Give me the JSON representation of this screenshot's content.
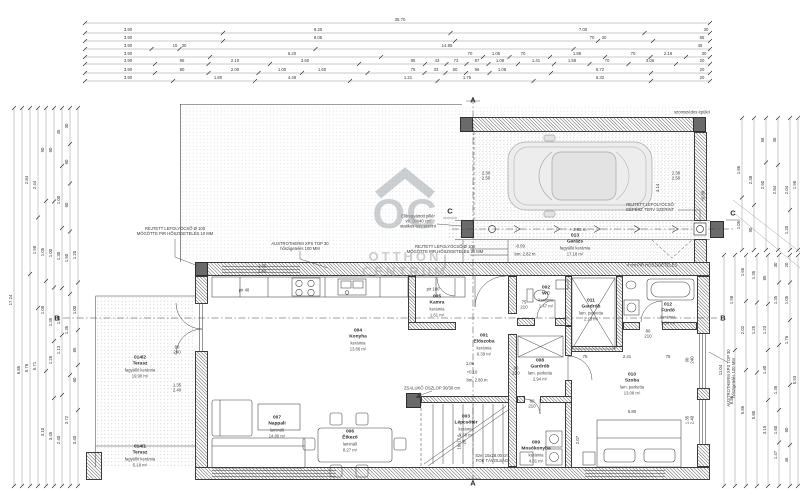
{
  "watermark": {
    "logo": "OC",
    "line1": "OTTHON",
    "line2": "CENTRUM"
  },
  "rooms": [
    {
      "num": "001",
      "name": "Előszoba",
      "finish": "kerámia",
      "area": "6.39 m²",
      "x": 484,
      "y": 345
    },
    {
      "num": "002",
      "name": "WC",
      "finish": "kerámia",
      "area": "1.47 m²",
      "x": 546,
      "y": 297
    },
    {
      "num": "003",
      "name": "Lépcsőtér",
      "finish": "kerámia",
      "area": "3.68 m²",
      "x": 466,
      "y": 426
    },
    {
      "num": "004",
      "name": "Konyha",
      "finish": "kerámia",
      "area": "13.86 m²",
      "x": 358,
      "y": 340
    },
    {
      "num": "005",
      "name": "Kamra",
      "finish": "kerámia",
      "area": "1.61 m²",
      "x": 437,
      "y": 306
    },
    {
      "num": "006",
      "name": "Étkező",
      "finish": "laminált",
      "area": "8.27 m²",
      "x": 350,
      "y": 441
    },
    {
      "num": "007",
      "name": "Nappali",
      "finish": "laminált",
      "area": "14.80 m²",
      "x": 277,
      "y": 427
    },
    {
      "num": "008",
      "name": "Gardrób",
      "finish": "lam. parketta",
      "area": "2.94 m²",
      "x": 540,
      "y": 370
    },
    {
      "num": "009",
      "name": "Mosókonyha",
      "finish": "kerámia",
      "area": "4.81 m²",
      "x": 536,
      "y": 452
    },
    {
      "num": "010",
      "name": "Szoba",
      "finish": "lam. parketta",
      "area": "13.08 m²",
      "x": 632,
      "y": 384
    },
    {
      "num": "011",
      "name": "Gardrób",
      "finish": "lam. parketta",
      "area": "2.13 m²",
      "x": 591,
      "y": 310
    },
    {
      "num": "012",
      "name": "Fürdő",
      "finish": "kerámia",
      "area": "5.34 m²",
      "x": 668,
      "y": 314
    },
    {
      "num": "013",
      "name": "Garázs",
      "finish": "fagyálló kerámia",
      "area": "17.18 m²",
      "x": 575,
      "y": 245
    },
    {
      "num": "014/1",
      "name": "Terasz",
      "finish": "fagyálló kerámia",
      "area": "5.18 m²",
      "x": 140,
      "y": 456
    },
    {
      "num": "014/2",
      "name": "Terasz",
      "finish": "fagyálló kerámia",
      "area": "19.90 m²",
      "x": 140,
      "y": 367
    }
  ],
  "annotations": [
    {
      "t": "REJTETT LEFOLYÓCSŐ Ø 100\nMÖGÖTTE PIR HŐSZIGETELÉS 10 MM",
      "x": 175,
      "y": 231
    },
    {
      "t": "AUSTROTHERM XPS TOP 30\nhőszigetelés 100 MM",
      "x": 300,
      "y": 246
    },
    {
      "t": "REJTETT LEFOLYÓCSŐ Ø 100\nMÖGÖTTE PIR HŐSZIGETELÉS 20 MM",
      "x": 445,
      "y": 249
    },
    {
      "t": "REJTETT LEFOLYÓCSŐ\nGÉPÉSZ TERV SZERINT",
      "x": 650,
      "y": 207
    },
    {
      "t": "Előregyártott pillér\nvb. 30x40 cm\nstatikus terv szerint",
      "x": 418,
      "y": 221
    },
    {
      "t": "4 cm PIR HŐSZIGETELÉS",
      "x": 652,
      "y": 264.5
    },
    {
      "t": "ZSALUKŐ OSZLOP 30/30 cm",
      "x": 432,
      "y": 388
    },
    {
      "t": "AUSTROTHERM XPS TOP 30\nhőszigetelés 100 MM",
      "x": 731,
      "y": 378,
      "rot": 1
    },
    {
      "t": "Sze: 15x28.00 cm\nFOK TÁVOLSÁG",
      "x": 492,
      "y": 458
    },
    {
      "t": "szomszédos épület",
      "x": 692,
      "y": 112
    },
    {
      "t": "pir 40",
      "x": 244,
      "y": 290
    },
    {
      "t": "pir 100",
      "x": 433,
      "y": 289
    },
    {
      "t": "+0.10",
      "x": 472,
      "y": 372
    },
    {
      "t": "bm: 2.80 m",
      "x": 477,
      "y": 380
    },
    {
      "t": "-0.09",
      "x": 520,
      "y": 246
    },
    {
      "t": "bm: 2.82 m",
      "x": 525,
      "y": 254
    },
    {
      "t": "+0.08",
      "x": 703,
      "y": 196,
      "rot": 1
    }
  ],
  "sections": [
    {
      "t": "A",
      "x": 473,
      "y": 100
    },
    {
      "t": "A",
      "x": 473,
      "y": 483
    },
    {
      "t": "B",
      "x": 57,
      "y": 318
    },
    {
      "t": "B",
      "x": 723,
      "y": 318
    },
    {
      "t": "C",
      "x": 450,
      "y": 211
    },
    {
      "t": "C",
      "x": 733,
      "y": 213
    }
  ],
  "dims": {
    "top_rows": [
      {
        "y": 23,
        "labels": [
          {
            "t": "35.70",
            "x": 400
          }
        ]
      },
      {
        "y": 33,
        "labels": [
          {
            "t": "3.90",
            "x": 128
          },
          {
            "t": "8.20",
            "x": 318
          },
          {
            "t": "7.00",
            "x": 583
          },
          {
            "t": "30",
            "x": 706
          }
        ]
      },
      {
        "y": 41,
        "labels": [
          {
            "t": "3.90",
            "x": 128
          },
          {
            "t": "8.05",
            "x": 318
          },
          {
            "t": "70",
            "x": 592
          },
          {
            "t": "30",
            "x": 604
          },
          {
            "t": "65",
            "x": 702
          }
        ]
      },
      {
        "y": 49,
        "labels": [
          {
            "t": "3.90",
            "x": 128
          },
          {
            "t": "15",
            "x": 175
          },
          {
            "t": "30",
            "x": 184
          },
          {
            "t": "14.85",
            "x": 447
          },
          {
            "t": "45",
            "x": 700
          }
        ]
      },
      {
        "y": 57,
        "labels": [
          {
            "t": "3.90",
            "x": 128
          },
          {
            "t": "6.20",
            "x": 292
          },
          {
            "t": "70",
            "x": 470
          },
          {
            "t": "1.05",
            "x": 496
          },
          {
            "t": "70",
            "x": 523
          },
          {
            "t": "1.88",
            "x": 577
          },
          {
            "t": "70",
            "x": 633
          },
          {
            "t": "2.18",
            "x": 668
          },
          {
            "t": "30",
            "x": 704
          }
        ]
      },
      {
        "y": 64,
        "labels": [
          {
            "t": "3.90",
            "x": 128
          },
          {
            "t": "95",
            "x": 182
          },
          {
            "t": "2.10",
            "x": 235
          },
          {
            "t": "3.60",
            "x": 305
          },
          {
            "t": "85",
            "x": 413
          },
          {
            "t": "43",
            "x": 437
          },
          {
            "t": "73",
            "x": 456
          },
          {
            "t": "87",
            "x": 477
          },
          {
            "t": "1.08",
            "x": 500
          },
          {
            "t": "1.41",
            "x": 536
          },
          {
            "t": "1.58",
            "x": 572
          },
          {
            "t": "70",
            "x": 607
          },
          {
            "t": "3.06",
            "x": 650
          },
          {
            "t": "20",
            "x": 702
          }
        ]
      },
      {
        "y": 73,
        "labels": [
          {
            "t": "3.90",
            "x": 128
          },
          {
            "t": "90",
            "x": 182
          },
          {
            "t": "2.00",
            "x": 235
          },
          {
            "t": "1.00",
            "x": 282
          },
          {
            "t": "1.60",
            "x": 322
          },
          {
            "t": "75",
            "x": 413
          },
          {
            "t": "33",
            "x": 436
          },
          {
            "t": "60",
            "x": 455
          },
          {
            "t": "96",
            "x": 477
          },
          {
            "t": "1.08",
            "x": 502
          },
          {
            "t": "5.72",
            "x": 600
          },
          {
            "t": "20",
            "x": 702
          }
        ]
      },
      {
        "y": 81,
        "labels": [
          {
            "t": "3.90",
            "x": 128
          },
          {
            "t": "1.80",
            "x": 218
          },
          {
            "t": "4.48",
            "x": 292
          },
          {
            "t": "1.21",
            "x": 408
          },
          {
            "t": "1.75",
            "x": 467
          },
          {
            "t": "6.32",
            "x": 600
          },
          {
            "t": "20",
            "x": 702
          }
        ]
      }
    ],
    "left_cols": [
      {
        "x": 14,
        "labels": [
          {
            "t": "17.24",
            "y": 300
          }
        ]
      },
      {
        "x": 22,
        "labels": [
          {
            "t": "6.85",
            "y": 370
          }
        ]
      },
      {
        "x": 30,
        "labels": [
          {
            "t": "2.84",
            "y": 180
          },
          {
            "t": "5.76",
            "y": 368
          }
        ]
      },
      {
        "x": 38,
        "labels": [
          {
            "t": "2.44",
            "y": 185
          },
          {
            "t": "1.98",
            "y": 250
          },
          {
            "t": "5.71",
            "y": 366
          }
        ]
      },
      {
        "x": 46,
        "labels": [
          {
            "t": "90",
            "y": 150
          },
          {
            "t": "1.05",
            "y": 252
          },
          {
            "t": "1.08",
            "y": 310
          },
          {
            "t": "3.10",
            "y": 432
          }
        ]
      },
      {
        "x": 54,
        "labels": [
          {
            "t": "60",
            "y": 150
          },
          {
            "t": "1.00",
            "y": 253
          },
          {
            "t": "1.35",
            "y": 322
          },
          {
            "t": "1.26",
            "y": 360
          },
          {
            "t": "3.45",
            "y": 436
          }
        ]
      },
      {
        "x": 62,
        "labels": [
          {
            "t": "45",
            "y": 132
          },
          {
            "t": "1.00",
            "y": 200
          },
          {
            "t": "1.30",
            "y": 256
          },
          {
            "t": "1.08",
            "y": 320
          },
          {
            "t": "1.13",
            "y": 350
          },
          {
            "t": "2.40",
            "y": 440
          }
        ]
      },
      {
        "x": 70,
        "labels": [
          {
            "t": "30",
            "y": 126
          },
          {
            "t": "90",
            "y": 162
          },
          {
            "t": "60",
            "y": 205
          },
          {
            "t": "1.50",
            "y": 258
          },
          {
            "t": "1.35",
            "y": 330
          },
          {
            "t": "3.72",
            "y": 420
          }
        ]
      },
      {
        "x": 78,
        "labels": [
          {
            "t": "1.20",
            "y": 255
          },
          {
            "t": "1.00",
            "y": 310
          },
          {
            "t": "85",
            "y": 350
          },
          {
            "t": "60",
            "y": 380
          },
          {
            "t": "3.40",
            "y": 440
          }
        ]
      }
    ],
    "right_cols": [
      {
        "x": 724,
        "labels": [
          {
            "t": "11.04",
            "y": 370
          }
        ]
      },
      {
        "x": 735,
        "labels": [
          {
            "t": "1.98",
            "y": 300
          },
          {
            "t": "8.86",
            "y": 400
          }
        ]
      },
      {
        "x": 746,
        "labels": [
          {
            "t": "1.66",
            "y": 272
          },
          {
            "t": "2.02",
            "y": 330
          },
          {
            "t": "5.86",
            "y": 410
          }
        ]
      },
      {
        "x": 757,
        "labels": [
          {
            "t": "1.35",
            "y": 275
          },
          {
            "t": "1.25",
            "y": 330
          },
          {
            "t": "5.80",
            "y": 415
          }
        ]
      },
      {
        "x": 768,
        "labels": [
          {
            "t": "85",
            "y": 278
          },
          {
            "t": "1.23",
            "y": 330
          },
          {
            "t": "1.40",
            "y": 370
          },
          {
            "t": "3.15",
            "y": 430
          }
        ]
      },
      {
        "x": 779,
        "labels": [
          {
            "t": "30",
            "y": 265
          },
          {
            "t": "1.35",
            "y": 300
          },
          {
            "t": "1.36",
            "y": 390
          },
          {
            "t": "1.60",
            "y": 430
          },
          {
            "t": "1.47",
            "y": 455
          }
        ]
      },
      {
        "x": 790,
        "labels": [
          {
            "t": "20",
            "y": 265
          },
          {
            "t": "1.05",
            "y": 300
          },
          {
            "t": "1.76",
            "y": 340
          },
          {
            "t": "60",
            "y": 430
          },
          {
            "t": "46",
            "y": 460
          }
        ]
      },
      {
        "x": 798,
        "labels": [
          {
            "t": "5.93",
            "y": 380
          }
        ]
      }
    ],
    "topright_cols": [
      {
        "x": 742,
        "labels": [
          {
            "t": "1.86",
            "y": 170
          },
          {
            "t": "1.05",
            "y": 225
          }
        ]
      },
      {
        "x": 754,
        "labels": [
          {
            "t": "2.38",
            "y": 180
          },
          {
            "t": "90",
            "y": 230
          }
        ]
      },
      {
        "x": 766,
        "labels": [
          {
            "t": "58",
            "y": 140
          },
          {
            "t": "2.50",
            "y": 185
          }
        ]
      },
      {
        "x": 778,
        "labels": [
          {
            "t": "36",
            "y": 140
          },
          {
            "t": "2.84",
            "y": 190
          }
        ]
      },
      {
        "x": 790,
        "labels": [
          {
            "t": "2.04",
            "y": 190
          },
          {
            "t": "1.20",
            "y": 230
          }
        ]
      },
      {
        "x": 798,
        "labels": [
          {
            "t": "1.98",
            "y": 185
          }
        ]
      }
    ],
    "inner": [
      {
        "t": "90\n240",
        "x": 177,
        "y": 350
      },
      {
        "t": "1.35\n2.40",
        "x": 177,
        "y": 388
      },
      {
        "t": "90\n210",
        "x": 516,
        "y": 371
      },
      {
        "t": "75\n210",
        "x": 524,
        "y": 305
      },
      {
        "t": "1.06",
        "x": 470,
        "y": 364
      },
      {
        "t": "5.80",
        "x": 632,
        "y": 412
      },
      {
        "t": "2.07",
        "x": 578,
        "y": 440,
        "rot": 1
      },
      {
        "t": "4.14",
        "x": 658,
        "y": 188,
        "rot": 1
      },
      {
        "t": "2.30\n2.50",
        "x": 486,
        "y": 176
      },
      {
        "t": "2.30\n2.50",
        "x": 676,
        "y": 176
      },
      {
        "t": "75",
        "x": 585,
        "y": 357
      },
      {
        "t": "2.41",
        "x": 627,
        "y": 357
      },
      {
        "t": "75",
        "x": 668,
        "y": 357
      },
      {
        "t": "80\n210",
        "x": 648,
        "y": 334
      },
      {
        "t": "60\n210",
        "x": 532,
        "y": 404
      },
      {
        "t": "90\n240",
        "x": 690,
        "y": 360,
        "rot": 1
      },
      {
        "t": "1.35\n2.40",
        "x": 690,
        "y": 420,
        "rot": 1
      },
      {
        "t": "1.35\n2.40",
        "x": 262,
        "y": 269
      },
      {
        "t": "+ 2.82 m",
        "x": 578,
        "y": 230
      },
      {
        "t": "16x17.5\n28",
        "x": 462,
        "y": 442,
        "rot": 1
      }
    ]
  }
}
